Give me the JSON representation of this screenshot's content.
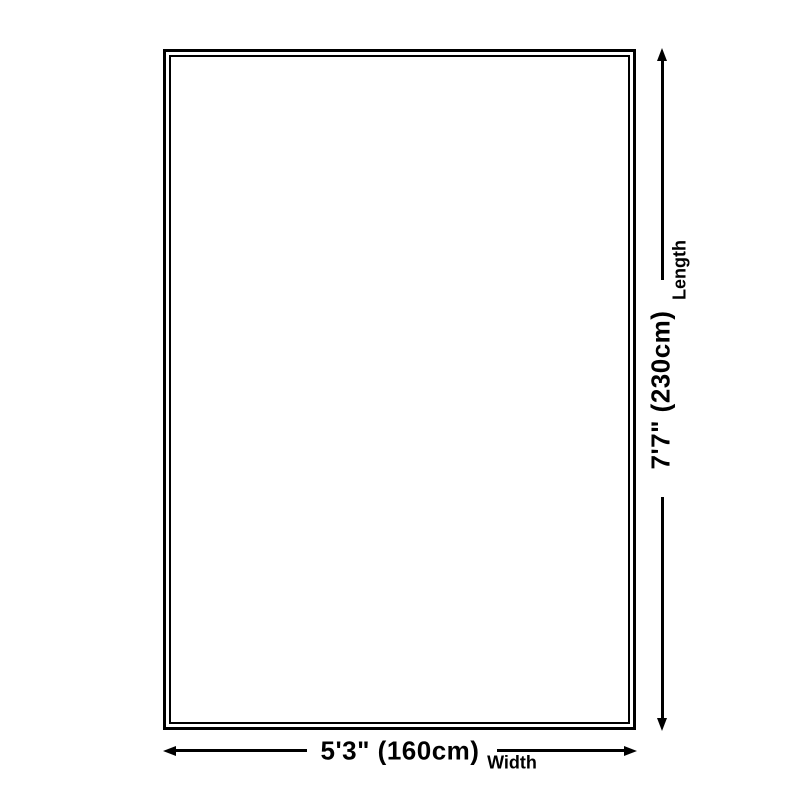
{
  "page": {
    "background_color": "#ffffff",
    "line_color": "#000000"
  },
  "diagram": {
    "type": "product-dimension-diagram",
    "shape": "rectangle-double-border",
    "width_dimension": {
      "value": "5'3\" (160cm)",
      "axis_label": "Width"
    },
    "length_dimension": {
      "value": "7'7\" (230cm)",
      "axis_label": "Length"
    }
  }
}
